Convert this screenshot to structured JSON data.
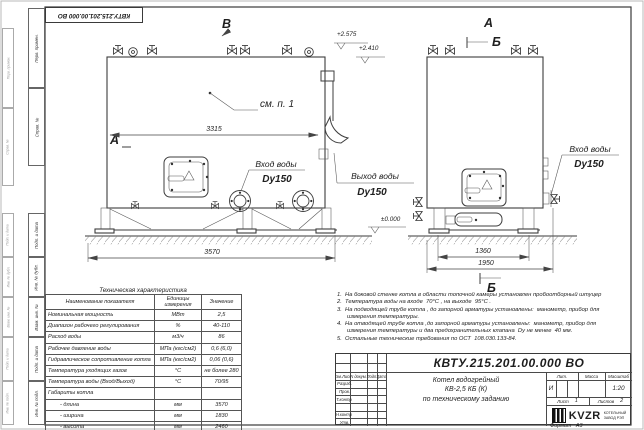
{
  "sheet": {
    "doc_number": "КВТУ.215.201.00.000  ВО",
    "format_label": "Формат   А3"
  },
  "margin_labels": [
    "Перв. примен.",
    "Справ. №",
    "Подп. и дата",
    "Инв. № дубл.",
    "Взам. инв. №",
    "Подп. и дата",
    "Инв. № подл."
  ],
  "drawing": {
    "view_b": "В",
    "view_a_left": "А",
    "view_a_right": "А",
    "section_b_top": "Б",
    "section_b_bottom": "Б",
    "see_note": "см. п. 1",
    "inlet_label": "Вход воды",
    "outlet_label": "Выход воды",
    "dn_label": "Dy150",
    "level_top": "+2.575",
    "level_mid": "+2.410",
    "level_zero": "±0.000",
    "dim_front_body": "3315",
    "dim_front_total": "3570",
    "dim_side_inner": "1360",
    "dim_side_total": "1950"
  },
  "tech_table": {
    "title": "Техническая характеристика",
    "headers": [
      "Наименование показателя",
      "Единицы измерения",
      "Значение"
    ],
    "rows": [
      {
        "name": "Номинальная мощность",
        "unit": "МВт",
        "value": "2,5"
      },
      {
        "name": "Диапазон рабочего регулирования",
        "unit": "%",
        "value": "40-110"
      },
      {
        "name": "Расход воды",
        "unit": "м3/ч",
        "value": "86"
      },
      {
        "name": "Рабочее давление воды",
        "unit": "МПа (кгс/см2)",
        "value": "0,6 (6,0)"
      },
      {
        "name": "Гидравлическое сопротивление котла",
        "unit": "МПа (кгс/см2)",
        "value": "0,06 (0,6)"
      },
      {
        "name": "Температура уходящих газов",
        "unit": "°С",
        "value": "не более 280"
      },
      {
        "name": "Температура воды (Вход/Выход)",
        "unit": "°С",
        "value": "70/95"
      },
      {
        "name": "Габариты котла",
        "unit": "",
        "value": ""
      },
      {
        "name": "- длина",
        "unit": "мм",
        "value": "3570"
      },
      {
        "name": "- ширина",
        "unit": "мм",
        "value": "1830"
      },
      {
        "name": "- высота",
        "unit": "мм",
        "value": "2460"
      }
    ]
  },
  "notes": {
    "lines": [
      "1.  На боковой стенке котла в области топочной камеры установлен пробоотборный штуцер",
      "2.  Температура воды на входе  70°С , на выходе  95°С .",
      "3.  На подводящей трубе котла , до запорной арматуры установлены:  манометр, прибор для",
      "измерения температуры.",
      "4.  На отводящей трубе котла ,до запорной арматуры установлены:  манометр, прибор для",
      "измерения температуры и два предохранительных клапана  Dу не менее  40 мм.",
      "5.  Остальные технические требования по ОСТ  108.030.133-84."
    ]
  },
  "title_block": {
    "doc_number": "КВТУ.215.201.00.000  ВО",
    "cols": [
      "Изм.Лист",
      "N докум.",
      "Подп.",
      "Дата"
    ],
    "rows": [
      "Разраб.",
      "Пров.",
      "Т.контр.",
      "",
      "Н.контр.",
      "Утв."
    ],
    "product_lines": [
      "Котел водогрейный",
      "КВ-2,5 КБ (К)",
      "по техническому заданию"
    ],
    "lit_label": "Лит.",
    "lit_value": "И",
    "mass_label": "Масса",
    "scale_label": "Масштаб",
    "scale_value": "1:20",
    "sheet_label": "Лист",
    "sheet_value": "1",
    "sheets_label": "Листов",
    "sheets_value": "2",
    "brand": "KVZR",
    "brand_sub": [
      "КОТЕЛЬНЫЙ",
      "ЗАВОД РЭП"
    ]
  }
}
